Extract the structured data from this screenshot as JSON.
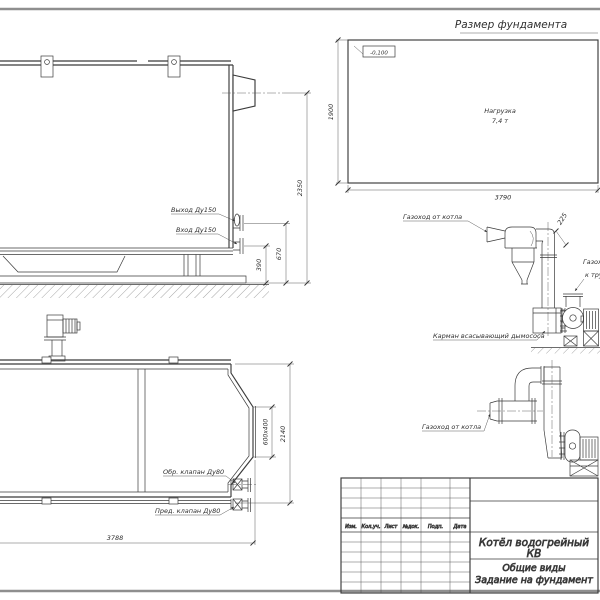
{
  "foundation_plan": {
    "title": "Размер фундамента",
    "elevation_mark": "-0,100",
    "load_line1": "Нагрузка",
    "load_line2": "7,4 т",
    "dim_length": "3790",
    "dim_width": "1900"
  },
  "boiler_side_view": {
    "label_outlet": "Выход Ду150",
    "label_inlet": "Вход Ду150",
    "dim_height_total": "2350",
    "dim_outlet": "670",
    "dim_inlet": "390"
  },
  "boiler_plan_view": {
    "label_check_valve": "Обр. клапан Ду80",
    "label_safety_valve": "Пред. клапан Ду80",
    "dim_length": "3788",
    "dim_width": "2140",
    "dim_flue_outlet": "600х400"
  },
  "flue_diagram_upper": {
    "label_from_boiler": "Газоход от котла",
    "dim_duct": "225",
    "label_to_stack_line1": "Газоход",
    "label_to_stack_line2": "к трубе",
    "label_suction_pocket": "Карман всасывающий дымососа"
  },
  "flue_diagram_lower": {
    "label_from_boiler": "Газоход от котла"
  },
  "title_block": {
    "columns": [
      "Изм.",
      "Кол.уч.",
      "Лист",
      "№док.",
      "Подп.",
      "Дата"
    ],
    "product_line1": "Котёл водогрейный",
    "product_line2": "КВ",
    "doc_line1": "Общие виды",
    "doc_line2": "Задание на фундамент"
  },
  "colors": {
    "line": "#3b3b3b",
    "border": "#8f8f8f",
    "background": "#ffffff"
  }
}
